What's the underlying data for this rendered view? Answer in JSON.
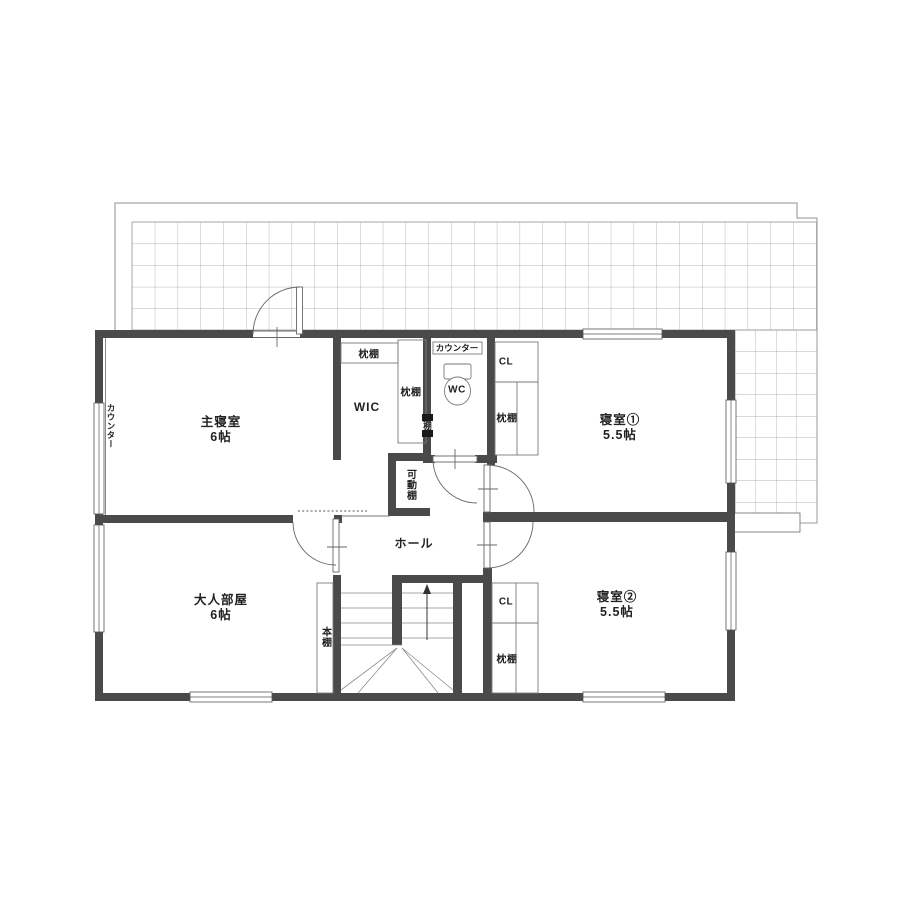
{
  "rooms": {
    "master_bedroom": {
      "name": "主寝室",
      "size": "6帖"
    },
    "adult_room": {
      "name": "大人部屋",
      "size": "6帖"
    },
    "bedroom1": {
      "name": "寝室①",
      "size": "5.5帖"
    },
    "bedroom2": {
      "name": "寝室②",
      "size": "5.5帖"
    },
    "hall": {
      "name": "ホール"
    },
    "wic": {
      "name": "WIC"
    },
    "wc": {
      "name": "WC"
    }
  },
  "fixtures": {
    "counter_master": "カウンター",
    "counter_wc": "カウンター",
    "wic_top_shelf": "枕棚",
    "wic_side_shelf": "枕棚",
    "wall_shelf": "棚",
    "movable_shelf": "可動棚",
    "bookshelf": "本棚",
    "closet1_label": "CL",
    "closet1_shelf": "枕棚",
    "closet2_label": "CL",
    "closet2_shelf": "枕棚"
  },
  "colors": {
    "wall": "#4a4a4a",
    "line": "#7a7a7a",
    "grid": "#9a9a9a",
    "text": "#222222"
  }
}
